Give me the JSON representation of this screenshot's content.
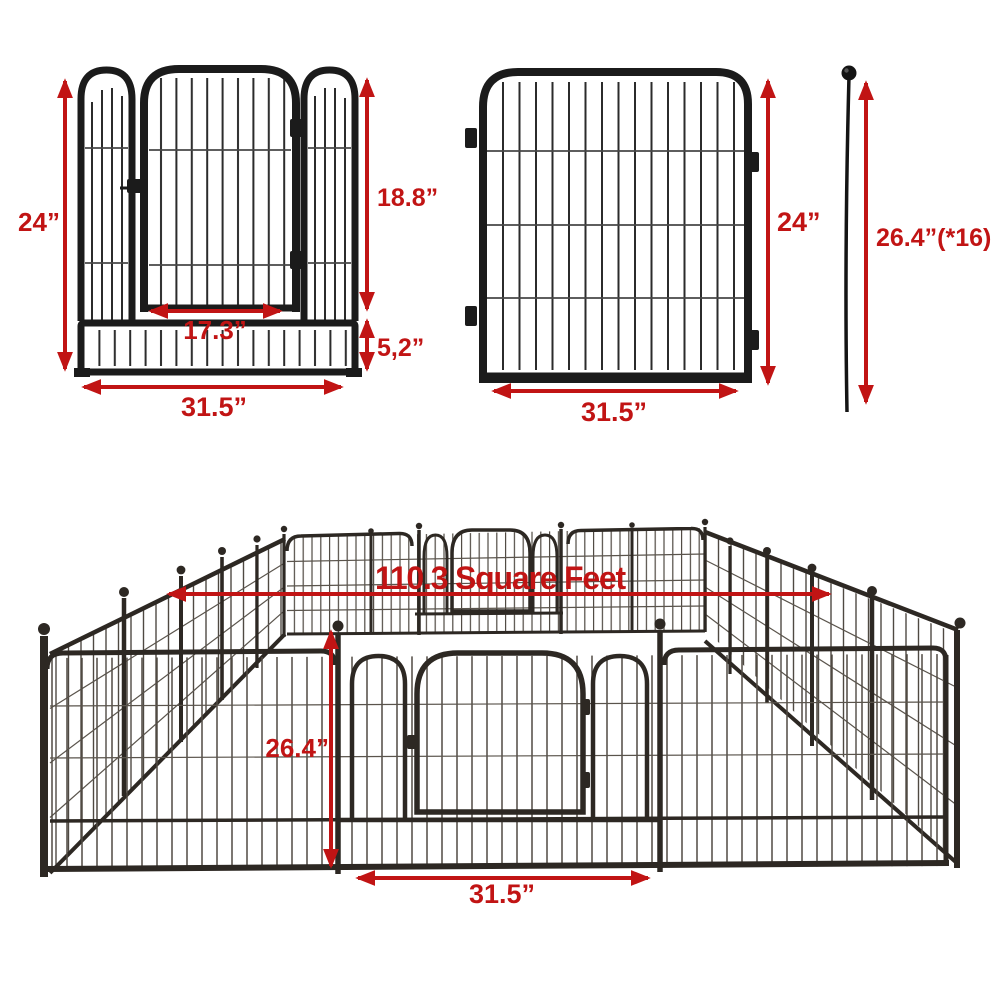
{
  "colors": {
    "dimension_red": "#c11414",
    "metal_black": "#1b1b1b",
    "metal_brown": "#2d2823",
    "background": "#ffffff"
  },
  "door_panel": {
    "height": "24”",
    "door_height": "18.8”",
    "door_width": "17.3”",
    "bottom_section_height": "5,2”",
    "width": "31.5”"
  },
  "plain_panel": {
    "height": "24”",
    "width": "31.5”"
  },
  "stake": {
    "length": "26.4”(*16)"
  },
  "playpen": {
    "area": "110.3 Square Feet",
    "panel_height": "26.4”",
    "door_panel_width": "31.5”"
  }
}
